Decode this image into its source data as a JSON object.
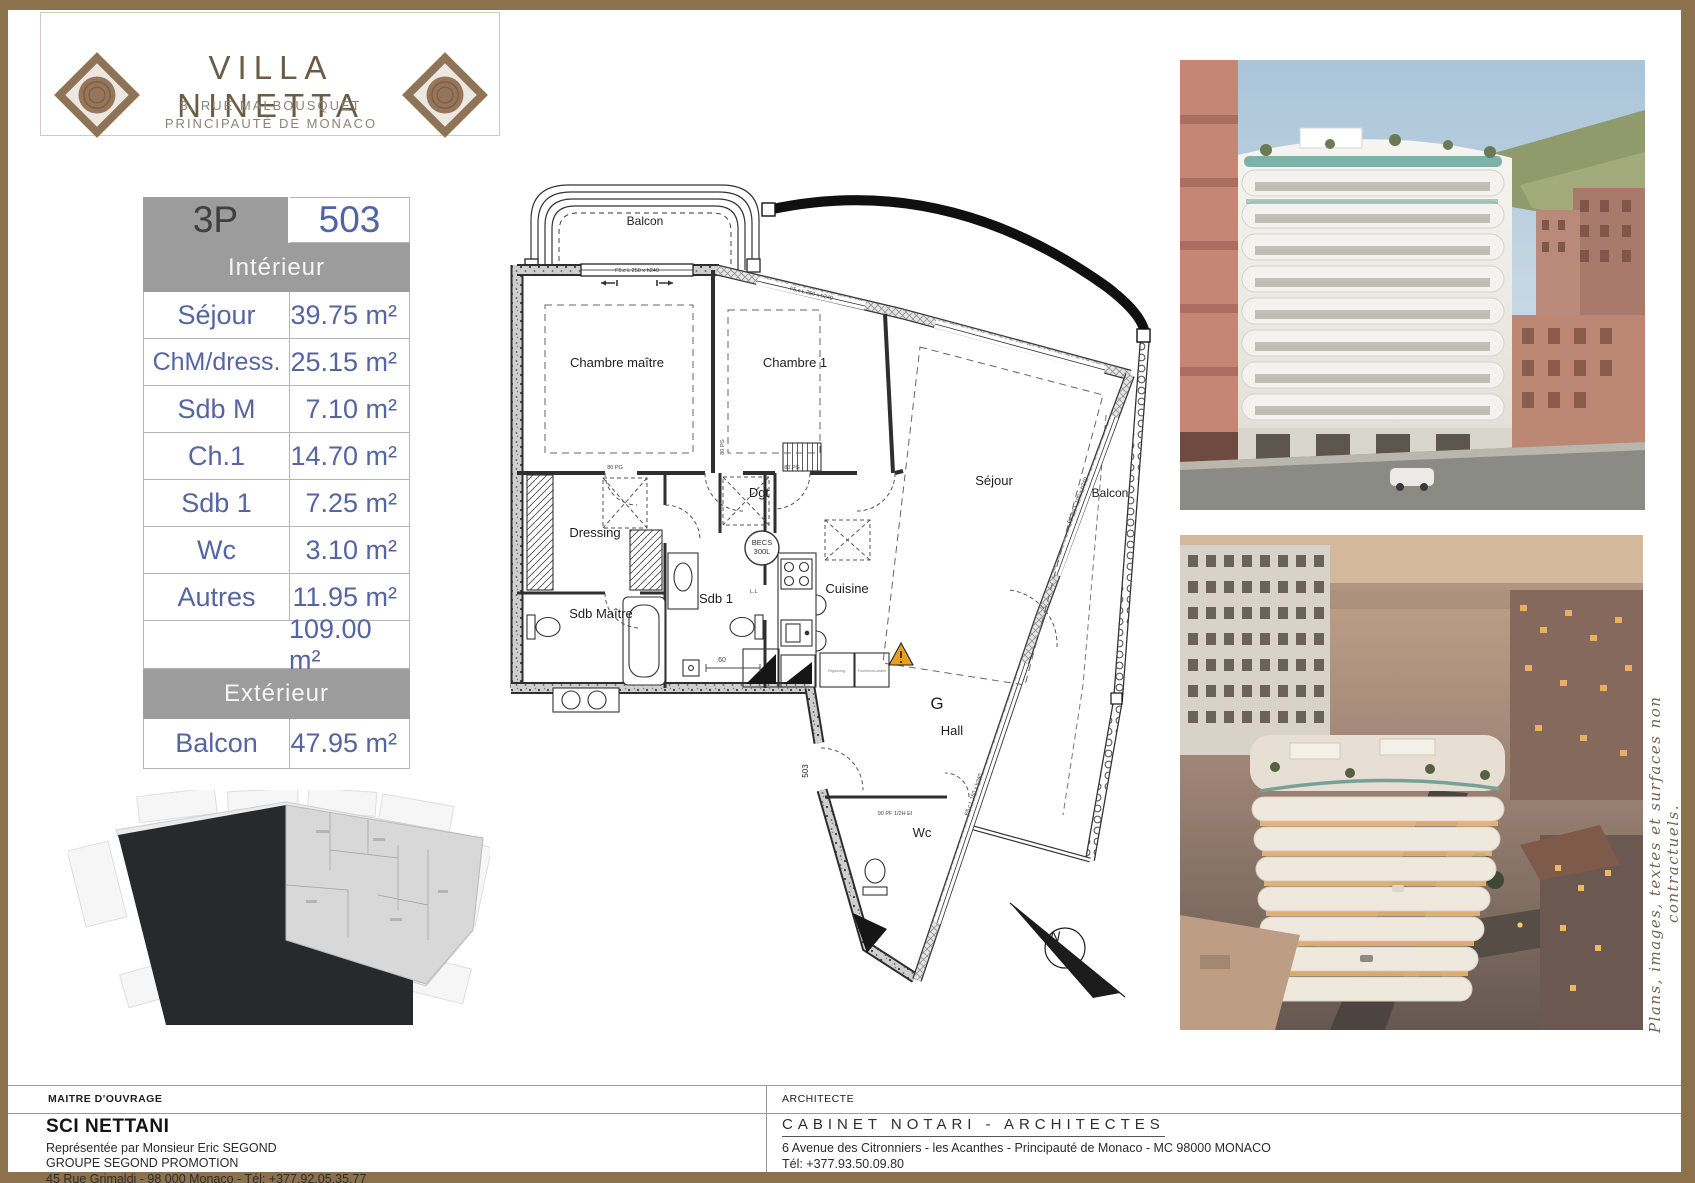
{
  "header": {
    "title": "VILLA NINETTA",
    "address_line1": "3, RUE MALBOUSQUET",
    "address_line2": "PRINCIPAUTÉ DE MONACO"
  },
  "area_table": {
    "type_label": "3P",
    "unit_number": "503",
    "interior_header": "Intérieur",
    "interior_rows": [
      {
        "label": "Séjour",
        "value": "39.75 m²"
      },
      {
        "label": "ChM/dress.",
        "value": "25.15 m²"
      },
      {
        "label": "Sdb M",
        "value": "7.10 m²"
      },
      {
        "label": "Ch.1",
        "value": "14.70 m²"
      },
      {
        "label": "Sdb 1",
        "value": "7.25 m²"
      },
      {
        "label": "Wc",
        "value": "3.10 m²"
      },
      {
        "label": "Autres",
        "value": "11.95 m²"
      }
    ],
    "interior_total": "109.00 m²",
    "exterior_header": "Extérieur",
    "exterior_rows": [
      {
        "label": "Balcon",
        "value": "47.95 m²"
      }
    ]
  },
  "floor_plan": {
    "labels": {
      "balcon_top": "Balcon",
      "chambre_maitre": "Chambre maître",
      "chambre_1": "Chambre 1",
      "sejour": "Séjour",
      "balcon_right": "Balcon",
      "dressing": "Dressing",
      "dgt": "Dgt",
      "sdb_1": "Sdb 1",
      "sdb_maitre": "Sdb Maître",
      "cuisine": "Cuisine",
      "hall_g": "G",
      "hall": "Hall",
      "wc": "Wc",
      "door_unit": "503",
      "becs_1": "BECS",
      "becs_2": "300L",
      "win_top": "F5.c  L 250 x h240",
      "win_mid": "F5.c  L 250 x h240",
      "win_right": "F4 fen  L 100 x h240",
      "win_low": "F5.c  L 160 x h240",
      "door_80": "80 PG",
      "door_90": "90 PF  1/2H EI",
      "dim_60": ".60",
      "ll": "L.L",
      "frigo": "Frigo/cong.",
      "four": "Four/micro-ondes",
      "north": "N"
    }
  },
  "disclaimer": "Plans, images, textes et surfaces non contractuels.",
  "footer": {
    "left": {
      "role": "MAITRE D'OUVRAGE",
      "company": "SCI NETTANI",
      "line1": "Représentée par Monsieur Eric SEGOND",
      "line2": "GROUPE SEGOND PROMOTION",
      "line3": "45 Rue Grimaldi - 98 000 Monaco -  Tél: +377.92.05.35.77"
    },
    "right": {
      "role": "ARCHITECTE",
      "company": "CABINET NOTARI - ARCHITECTES",
      "line1": "6 Avenue des Citronniers - les Acanthes - Principauté de Monaco - MC 98000 MONACO",
      "line2": "Tél: +377.93.50.09.80"
    }
  }
}
